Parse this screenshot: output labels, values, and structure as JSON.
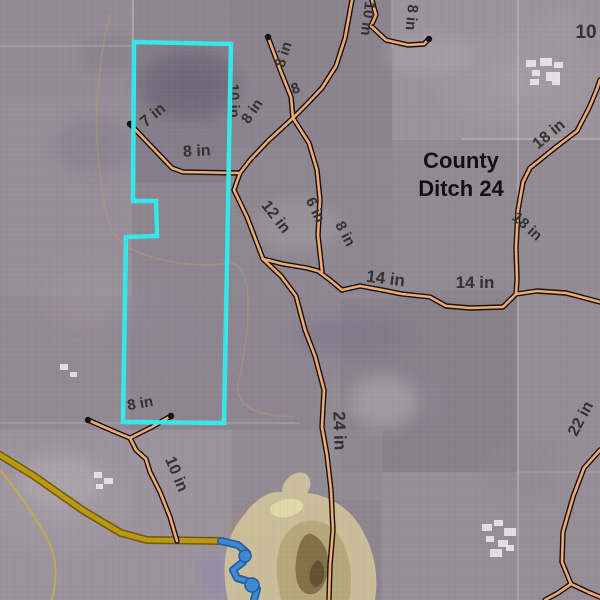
{
  "map": {
    "title": {
      "lines": [
        "County",
        "Ditch 24"
      ],
      "x": 461,
      "y": 168,
      "line_height": 28,
      "size": 22
    },
    "colors": {
      "label": "#32322c",
      "title": "#101010",
      "tile_casing": "#111111",
      "tile_core": "#f2aa72",
      "parcel": "#35e7ea",
      "ditch_edge": "#6b5a10",
      "ditch_core": "#bb980f",
      "stream_edge": "#1f5fa6",
      "stream_core": "#4189cf",
      "grid": "#d8d2d6",
      "contour": "#b1a264",
      "contour_bright": "#c3b23e",
      "wetland": "#cfc29a",
      "wetland_mid": "#b5a375",
      "wetland_dark": "#7e6b45",
      "farmstead": "#eae7e9"
    },
    "pipe_labels": [
      {
        "text": "10 in",
        "x": 229,
        "y": 101,
        "rot": 88,
        "size": 15
      },
      {
        "text": "8 in",
        "x": 256,
        "y": 114,
        "rot": -55,
        "size": 15
      },
      {
        "text": "8 in",
        "x": 288,
        "y": 56,
        "rot": -72,
        "size": 15
      },
      {
        "text": "8",
        "x": 297,
        "y": 93,
        "rot": -20,
        "size": 15
      },
      {
        "text": "10 in",
        "x": 363,
        "y": 18,
        "rot": 97,
        "size": 15
      },
      {
        "text": "8 in",
        "x": 407,
        "y": 17,
        "rot": 95,
        "size": 15
      },
      {
        "text": "8 in",
        "x": 197,
        "y": 156,
        "rot": -3,
        "size": 16
      },
      {
        "text": "7 in",
        "x": 156,
        "y": 119,
        "rot": -40,
        "size": 16
      },
      {
        "text": "10",
        "x": 586,
        "y": 38,
        "rot": 0,
        "size": 19
      },
      {
        "text": "18 in",
        "x": 552,
        "y": 138,
        "rot": -40,
        "size": 16
      },
      {
        "text": "18 in",
        "x": 524,
        "y": 230,
        "rot": 42,
        "size": 15
      },
      {
        "text": "12 in",
        "x": 272,
        "y": 220,
        "rot": 52,
        "size": 16
      },
      {
        "text": "6 in",
        "x": 311,
        "y": 212,
        "rot": 65,
        "size": 15
      },
      {
        "text": "8 in",
        "x": 341,
        "y": 236,
        "rot": 62,
        "size": 15
      },
      {
        "text": "14 in",
        "x": 385,
        "y": 284,
        "rot": 7,
        "size": 17
      },
      {
        "text": "14 in",
        "x": 475,
        "y": 288,
        "rot": 0,
        "size": 17
      },
      {
        "text": "24 in",
        "x": 334,
        "y": 431,
        "rot": 88,
        "size": 17
      },
      {
        "text": "10 in",
        "x": 172,
        "y": 476,
        "rot": 67,
        "size": 16
      },
      {
        "text": "8 in",
        "x": 141,
        "y": 408,
        "rot": -10,
        "size": 15
      },
      {
        "text": "22 in",
        "x": 585,
        "y": 421,
        "rot": -62,
        "size": 16
      }
    ],
    "tile_lines": [
      {
        "name": "lateral-7in-8in-west",
        "points": [
          [
            130,
            124
          ],
          [
            149,
            144
          ],
          [
            172,
            168
          ],
          [
            183,
            172
          ],
          [
            240,
            173
          ]
        ]
      },
      {
        "name": "main-north",
        "points": [
          [
            352,
            0
          ],
          [
            345,
            38
          ],
          [
            336,
            66
          ],
          [
            322,
            88
          ],
          [
            305,
            106
          ],
          [
            293,
            118
          ]
        ]
      },
      {
        "name": "north-zigzag-8in",
        "points": [
          [
            372,
            0
          ],
          [
            376,
            15
          ],
          [
            371,
            26
          ],
          [
            386,
            40
          ],
          [
            408,
            45
          ],
          [
            424,
            44
          ],
          [
            429,
            39
          ]
        ]
      },
      {
        "name": "north-west-8in",
        "points": [
          [
            268,
            37
          ],
          [
            281,
            72
          ],
          [
            291,
            97
          ],
          [
            293,
            118
          ]
        ]
      },
      {
        "name": "junction-link",
        "points": [
          [
            293,
            118
          ],
          [
            268,
            141
          ],
          [
            250,
            160
          ],
          [
            240,
            173
          ]
        ]
      },
      {
        "name": "lateral-6in",
        "points": [
          [
            293,
            118
          ],
          [
            309,
            143
          ],
          [
            317,
            170
          ],
          [
            320,
            200
          ],
          [
            318,
            235
          ],
          [
            321,
            262
          ],
          [
            322,
            272
          ]
        ]
      },
      {
        "name": "trunk-12in-24in",
        "points": [
          [
            240,
            173
          ],
          [
            234,
            190
          ],
          [
            247,
            217
          ],
          [
            263,
            259
          ],
          [
            281,
            276
          ],
          [
            296,
            296
          ],
          [
            305,
            330
          ],
          [
            315,
            356
          ],
          [
            324,
            390
          ],
          [
            322,
            427
          ],
          [
            327,
            455
          ],
          [
            331,
            490
          ],
          [
            333,
            530
          ],
          [
            330,
            565
          ],
          [
            329,
            600
          ]
        ]
      },
      {
        "name": "branch-14in-east",
        "points": [
          [
            263,
            259
          ],
          [
            283,
            264
          ],
          [
            307,
            268
          ],
          [
            318,
            271
          ],
          [
            330,
            280
          ],
          [
            342,
            290
          ],
          [
            360,
            286
          ],
          [
            382,
            290
          ],
          [
            402,
            294
          ],
          [
            430,
            297
          ],
          [
            446,
            306
          ],
          [
            470,
            308
          ],
          [
            503,
            307
          ],
          [
            516,
            294
          ],
          [
            537,
            291
          ],
          [
            566,
            293
          ],
          [
            600,
            302
          ]
        ]
      },
      {
        "name": "ditch-18in-vertical",
        "points": [
          [
            530,
            168
          ],
          [
            523,
            182
          ],
          [
            518,
            210
          ],
          [
            516,
            248
          ],
          [
            517,
            280
          ],
          [
            516,
            294
          ]
        ]
      },
      {
        "name": "ditch-18in-diagonal",
        "points": [
          [
            530,
            168
          ],
          [
            556,
            147
          ],
          [
            577,
            131
          ],
          [
            589,
            108
          ],
          [
            597,
            89
          ],
          [
            600,
            80
          ]
        ]
      },
      {
        "name": "main-22in-southeast",
        "points": [
          [
            600,
            450
          ],
          [
            584,
            468
          ],
          [
            573,
            497
          ],
          [
            563,
            532
          ],
          [
            562,
            562
          ],
          [
            571,
            584
          ]
        ]
      },
      {
        "name": "branch-22in-corner",
        "points": [
          [
            571,
            584
          ],
          [
            588,
            592
          ],
          [
            600,
            597
          ]
        ]
      },
      {
        "name": "branch-22in-south",
        "points": [
          [
            571,
            584
          ],
          [
            558,
            593
          ],
          [
            545,
            600
          ]
        ]
      },
      {
        "name": "lateral-10in-south",
        "points": [
          [
            88,
            420
          ],
          [
            113,
            431
          ],
          [
            130,
            438
          ],
          [
            136,
            450
          ],
          [
            146,
            459
          ],
          [
            150,
            472
          ],
          [
            160,
            492
          ],
          [
            170,
            517
          ],
          [
            177,
            541
          ]
        ]
      },
      {
        "name": "lateral-8in-stub",
        "points": [
          [
            130,
            438
          ],
          [
            152,
            427
          ],
          [
            171,
            416
          ]
        ]
      }
    ],
    "capped_ends": [
      [
        130,
        124
      ],
      [
        429,
        39
      ],
      [
        268,
        37
      ],
      [
        171,
        416
      ],
      [
        88,
        420
      ]
    ],
    "parcel": {
      "points": [
        [
          134,
          42
        ],
        [
          231,
          44
        ],
        [
          224,
          423
        ],
        [
          123,
          422
        ],
        [
          126,
          237
        ],
        [
          157,
          236
        ],
        [
          156,
          201
        ],
        [
          133,
          201
        ]
      ]
    },
    "waterway": {
      "points": [
        [
          0,
          455
        ],
        [
          34,
          476
        ],
        [
          84,
          511
        ],
        [
          121,
          533
        ],
        [
          147,
          540
        ],
        [
          222,
          541
        ]
      ]
    },
    "stream": {
      "points": [
        [
          221,
          541
        ],
        [
          238,
          545
        ],
        [
          247,
          553
        ],
        [
          243,
          562
        ],
        [
          233,
          570
        ],
        [
          237,
          578
        ],
        [
          250,
          582
        ],
        [
          257,
          589
        ],
        [
          254,
          600
        ]
      ],
      "pools": [
        [
          252,
          585,
          7,
          7
        ],
        [
          245,
          556,
          6,
          6
        ]
      ]
    },
    "contours": [
      {
        "d": "M110,14 C98,60 94,120 99,165 C102,190 104,212 113,233 C124,250 152,259 180,263 C200,266 218,265 228,263 C241,261 247,278 248,300 C249,330 243,360 238,385 C236,400 247,409 262,413 C277,416 288,417 295,417",
        "w": 1.6,
        "op": 0.5,
        "bright": false
      },
      {
        "d": "M0,470 C15,488 35,515 48,540 C56,556 58,576 52,600",
        "w": 2.2,
        "op": 0.75,
        "bright": true
      }
    ],
    "wetland_paths": [
      {
        "d": "M228,600 C220,565 226,535 244,515 C254,500 270,490 282,492 C282,480 294,470 304,473 C312,477 312,487 307,493 C330,495 352,510 362,530 C374,550 379,575 375,600 Z",
        "fill": "wetland",
        "op": 0.92
      },
      {
        "d": "M281,600 C273,566 276,540 293,527 C309,515 331,521 341,539 C351,557 353,581 349,600 Z",
        "fill": "wetland_mid",
        "op": 0.85
      },
      {
        "d": "M312,534 C324,540 330,553 328,570 C326,586 318,596 308,594 C298,592 294,578 296,560 C298,544 304,531 312,534 Z",
        "fill": "wetland_dark",
        "op": 0.9
      },
      {
        "d": "M318,560 C324,563 326,572 323,580 C320,588 314,589 311,583 C308,577 310,564 318,560 Z",
        "fill": "#5e4e31",
        "op": 0.9
      },
      {
        "d": "M272,505 C282,498 296,497 302,502 C306,507 300,514 288,517 C276,520 266,512 272,505 Z",
        "fill": "#e3d9ad",
        "op": 0.9
      }
    ],
    "fields": [
      [
        0,
        0,
        134,
        96,
        "#998f99",
        0.55
      ],
      [
        0,
        96,
        132,
        200,
        "#a096a0",
        0.5
      ],
      [
        0,
        296,
        130,
        134,
        "#988e99",
        0.45
      ],
      [
        134,
        42,
        96,
        140,
        "#7e7583",
        0.5
      ],
      [
        230,
        0,
        162,
        148,
        "#8a818c",
        0.5
      ],
      [
        392,
        0,
        208,
        140,
        "#a89fa6",
        0.55
      ],
      [
        134,
        182,
        92,
        242,
        "#8d8590",
        0.45
      ],
      [
        226,
        148,
        166,
        150,
        "#8f8692",
        0.4
      ],
      [
        392,
        140,
        208,
        150,
        "#968d96",
        0.5
      ],
      [
        340,
        298,
        178,
        174,
        "#827b86",
        0.5
      ],
      [
        518,
        290,
        82,
        182,
        "#9c939b",
        0.5
      ],
      [
        0,
        430,
        232,
        170,
        "#a89ea6",
        0.55
      ],
      [
        232,
        430,
        150,
        70,
        "#9a9099",
        0.4
      ],
      [
        382,
        472,
        218,
        128,
        "#9e959d",
        0.5
      ],
      [
        518,
        140,
        82,
        150,
        "#948b94",
        0.45
      ]
    ],
    "blobs": [
      [
        190,
        85,
        48,
        34,
        "#6a6273",
        0.5
      ],
      [
        95,
        145,
        40,
        28,
        "#80788a",
        0.4
      ],
      [
        298,
        226,
        42,
        26,
        "#aa9ea8",
        0.45
      ],
      [
        383,
        402,
        34,
        26,
        "#b5abb1",
        0.5
      ],
      [
        430,
        55,
        45,
        20,
        "#b0a6ac",
        0.4
      ],
      [
        160,
        335,
        50,
        38,
        "#8f8694",
        0.45
      ],
      [
        60,
        480,
        42,
        24,
        "#b6acb2",
        0.45
      ],
      [
        520,
        468,
        38,
        28,
        "#8f8690",
        0.4
      ],
      [
        350,
        335,
        60,
        16,
        "#757086",
        0.35
      ],
      [
        250,
        520,
        30,
        20,
        "#9d9489",
        0.4
      ],
      [
        110,
        55,
        30,
        18,
        "#7c7480",
        0.4
      ],
      [
        560,
        30,
        28,
        16,
        "#a79da4",
        0.4
      ],
      [
        214,
        575,
        14,
        28,
        "#9488ad",
        0.55
      ]
    ],
    "grid_lines": [
      [
        518,
        0,
        518,
        600,
        0.45,
        1.6
      ],
      [
        133,
        0,
        133,
        44,
        0.5,
        1.6
      ],
      [
        462,
        139,
        600,
        139,
        0.4,
        1.5
      ],
      [
        0,
        423,
        300,
        423,
        0.3,
        1.5
      ],
      [
        392,
        0,
        392,
        48,
        0.35,
        1.4
      ],
      [
        0,
        46,
        133,
        46,
        0.3,
        1.4
      ],
      [
        518,
        472,
        600,
        472,
        0.3,
        1.3
      ]
    ],
    "farmsteads": [
      [
        526,
        60,
        10,
        7
      ],
      [
        540,
        58,
        12,
        8
      ],
      [
        554,
        62,
        9,
        6
      ],
      [
        532,
        70,
        8,
        6
      ],
      [
        546,
        72,
        14,
        9
      ],
      [
        530,
        79,
        9,
        6
      ],
      [
        552,
        80,
        8,
        5
      ],
      [
        482,
        524,
        10,
        7
      ],
      [
        494,
        520,
        9,
        6
      ],
      [
        504,
        528,
        12,
        8
      ],
      [
        486,
        536,
        8,
        6
      ],
      [
        498,
        540,
        10,
        7
      ],
      [
        490,
        549,
        12,
        8
      ],
      [
        506,
        545,
        8,
        6
      ],
      [
        94,
        472,
        8,
        6
      ],
      [
        104,
        478,
        9,
        6
      ],
      [
        96,
        484,
        7,
        5
      ],
      [
        60,
        364,
        8,
        6
      ],
      [
        70,
        372,
        7,
        5
      ]
    ]
  }
}
